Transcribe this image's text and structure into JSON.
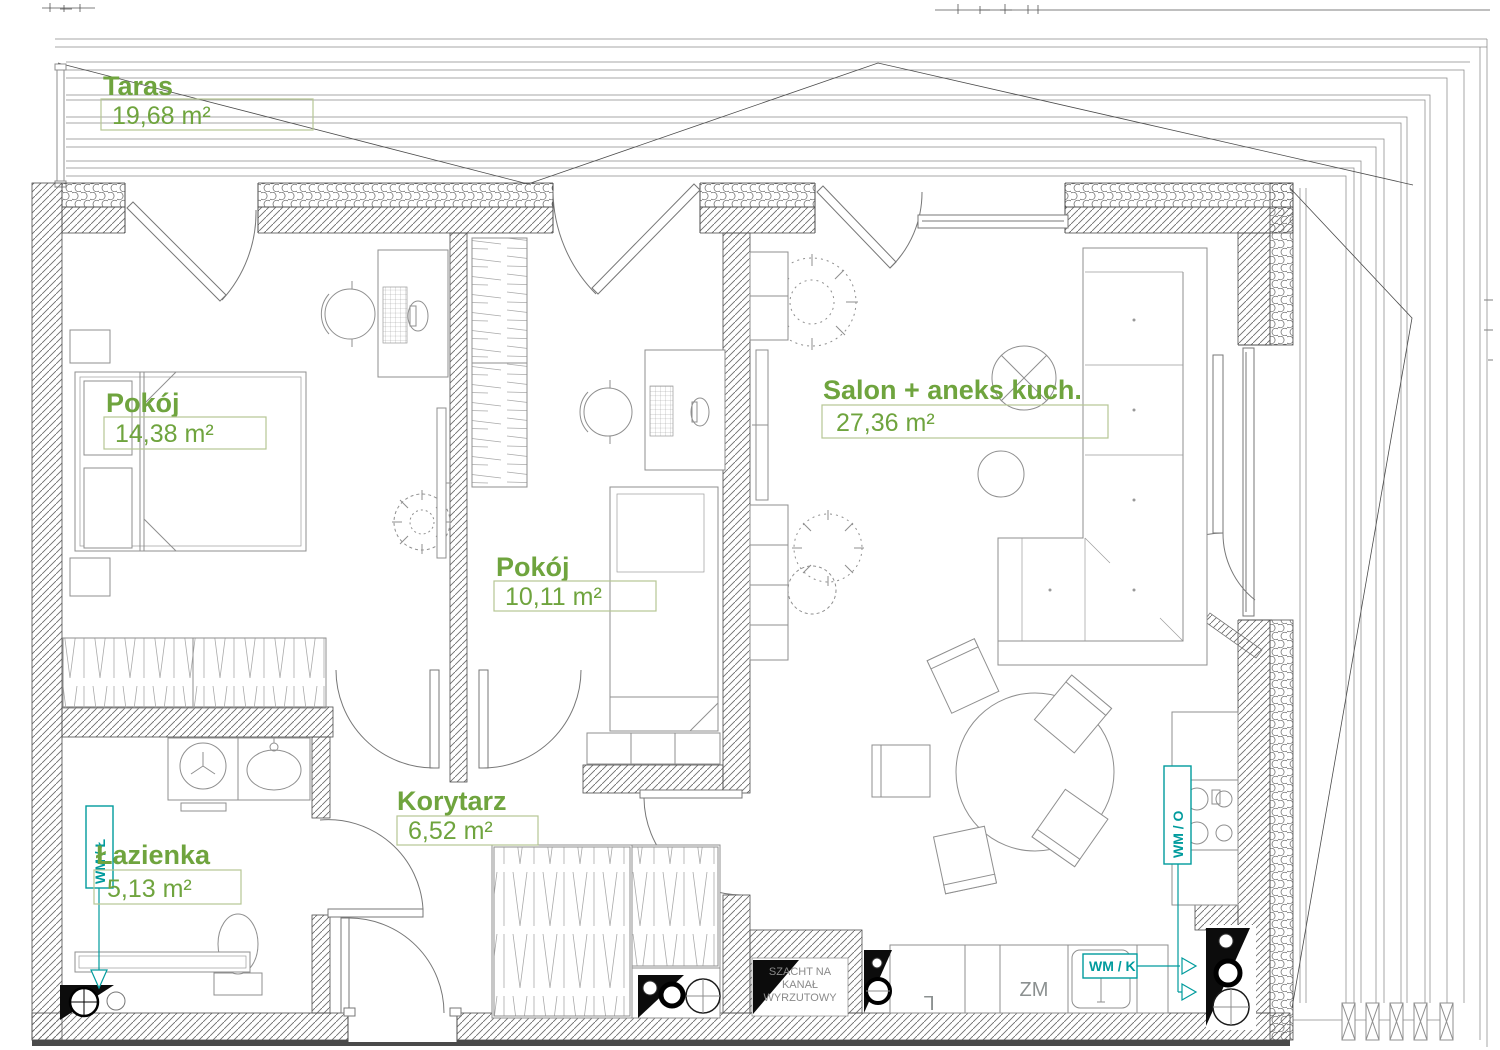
{
  "plan": {
    "type": "apartment-floor-plan",
    "language": "pl",
    "rooms": [
      {
        "name": "Taras",
        "area": "19,68 m²"
      },
      {
        "name": "Pokój",
        "area": "14,38 m²"
      },
      {
        "name": "Pokój",
        "area": "10,11 m²"
      },
      {
        "name": "Salon + aneks kuch.",
        "area": "27,36 m²"
      },
      {
        "name": "Korytarz",
        "area": "6,52 m²"
      },
      {
        "name": "Łazienka",
        "area": "5,13 m²"
      }
    ],
    "annotations": {
      "wm_l": "WM / Ł",
      "wm_k": "WM / K",
      "wm_o": "WM / O",
      "zm": "ZM",
      "fridge": "L",
      "shaft_line1": "SZACHT NA",
      "shaft_line2": "KANAŁ",
      "shaft_line3": "WYRZUTOWY"
    },
    "colors": {
      "room_label": "#6fa43e",
      "area_box_border": "#b6c694",
      "plumbing_label": "#009b9d",
      "drawing_lines": "#6e6e6e",
      "shaft_fill": "#0c0c0c"
    }
  }
}
